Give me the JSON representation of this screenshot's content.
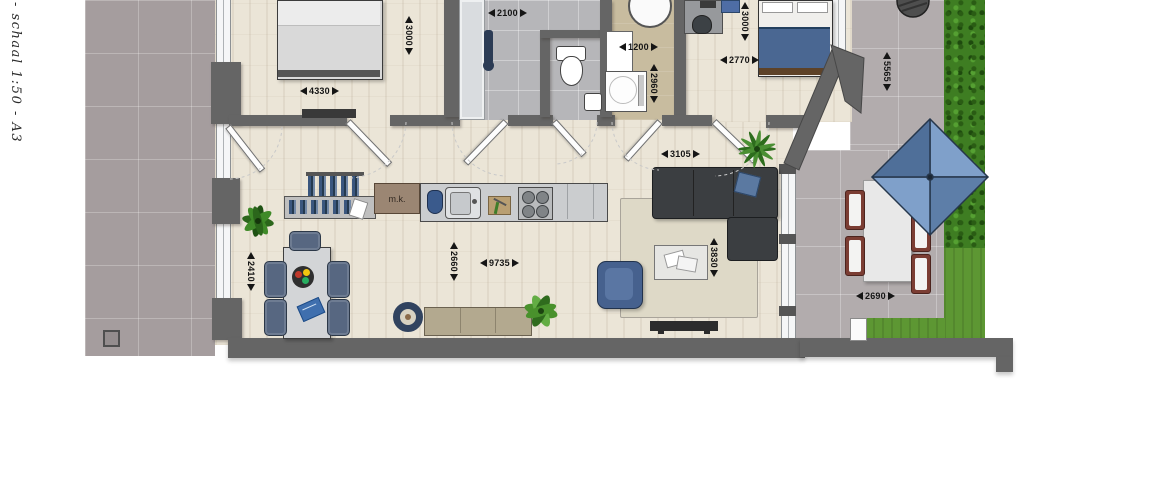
{
  "meta": {
    "scale_label": "- schaal 1:50 - A3"
  },
  "plan": {
    "labels": {
      "meter_cupboard": "m.k."
    },
    "dimensions": {
      "bedroom1_width": "4330",
      "bedroom1_depth": "3000",
      "bathroom_width": "2100",
      "utility_width": "1200",
      "utility_depth": "2960",
      "bedroom2_width": "2770",
      "bedroom2_depth": "3000",
      "hall_lounge_width": "3105",
      "dining_zone_depth": "2410",
      "kitchen_zone_depth": "2660",
      "living_room_length": "9735",
      "lounge_zone_depth": "3830",
      "garden_terrace_depth": "5565",
      "garden_terrace_width": "2690"
    },
    "colors": {
      "wall": "#656565",
      "wood_floor": "#ebe5d7",
      "terrace_tile_left": "#a59d9e",
      "terrace_tile_right": "#b2acad",
      "bathroom_tile": "#b6b6b9",
      "utility_floor": "#c8bc9f",
      "hedge_green": "#3e7d22",
      "grass_green": "#5d9733",
      "parasol_blue": "#6f8fba",
      "sofa_charcoal": "#3b3e41",
      "accent_blue": "#4a6792"
    }
  }
}
